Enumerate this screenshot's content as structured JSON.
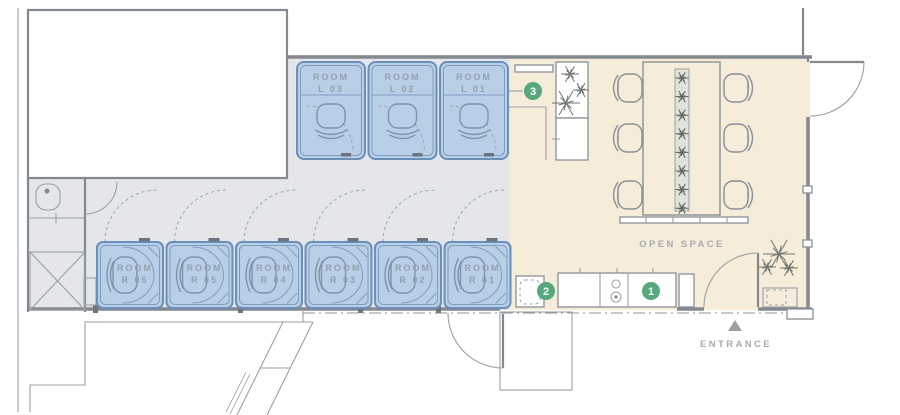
{
  "floor_plan": {
    "rooms_top": [
      {
        "line1": "ROOM",
        "line2": "L 03"
      },
      {
        "line1": "ROOM",
        "line2": "L 02"
      },
      {
        "line1": "ROOM",
        "line2": "L 01"
      }
    ],
    "rooms_bottom": [
      {
        "line1": "ROOM",
        "line2": "R 06"
      },
      {
        "line1": "ROOM",
        "line2": "R 05"
      },
      {
        "line1": "ROOM",
        "line2": "R 04"
      },
      {
        "line1": "ROOM",
        "line2": "R 03"
      },
      {
        "line1": "ROOM",
        "line2": "R 02"
      },
      {
        "line1": "ROOM",
        "line2": "R 01"
      }
    ],
    "labels": {
      "open_space": "OPEN SPACE",
      "entrance": "ENTRANCE"
    },
    "markers": [
      {
        "number": "1"
      },
      {
        "number": "2"
      },
      {
        "number": "3"
      }
    ],
    "colors": {
      "room_fill": "#b9cfe8",
      "room_border": "#6a8fb9",
      "room_inner": "#7e9cc0",
      "room_label": "#93a0b0",
      "corridor_floor": "#e4e6e9",
      "open_space_floor": "#f5edd9",
      "marker_green": "#57a87c",
      "wall_gray": "#84898f",
      "text_gray": "#a6abb1"
    }
  }
}
